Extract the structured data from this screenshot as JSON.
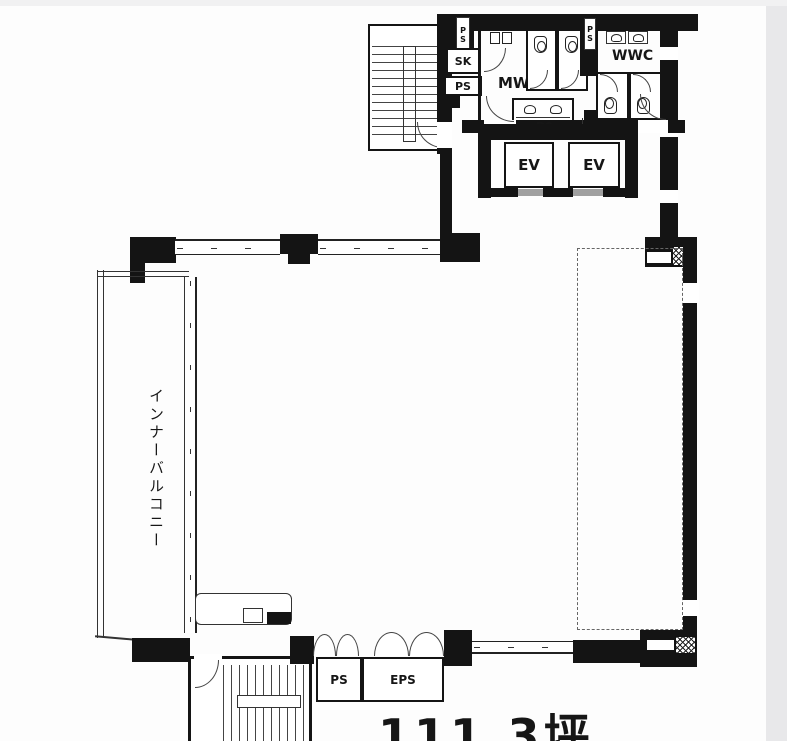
{
  "plan": {
    "area_label": "111.3坪",
    "balcony_label": "インナーバルコニー",
    "labels": {
      "sk": "SK",
      "ps_top": "PS",
      "ps_shaft_left": "PS",
      "ps_shaft_mid": "PS",
      "mwc": "MWC",
      "wwc": "WWC",
      "ps_leader": "PS",
      "ev_left": "EV",
      "ev_right": "EV",
      "ps_bottom": "PS",
      "eps": "EPS"
    },
    "colors": {
      "wall": "#141414",
      "line": "#333333",
      "paper": "#ffffff",
      "elevator_door": "#a0a0a0",
      "scan_band": "#e8e8ea"
    }
  }
}
